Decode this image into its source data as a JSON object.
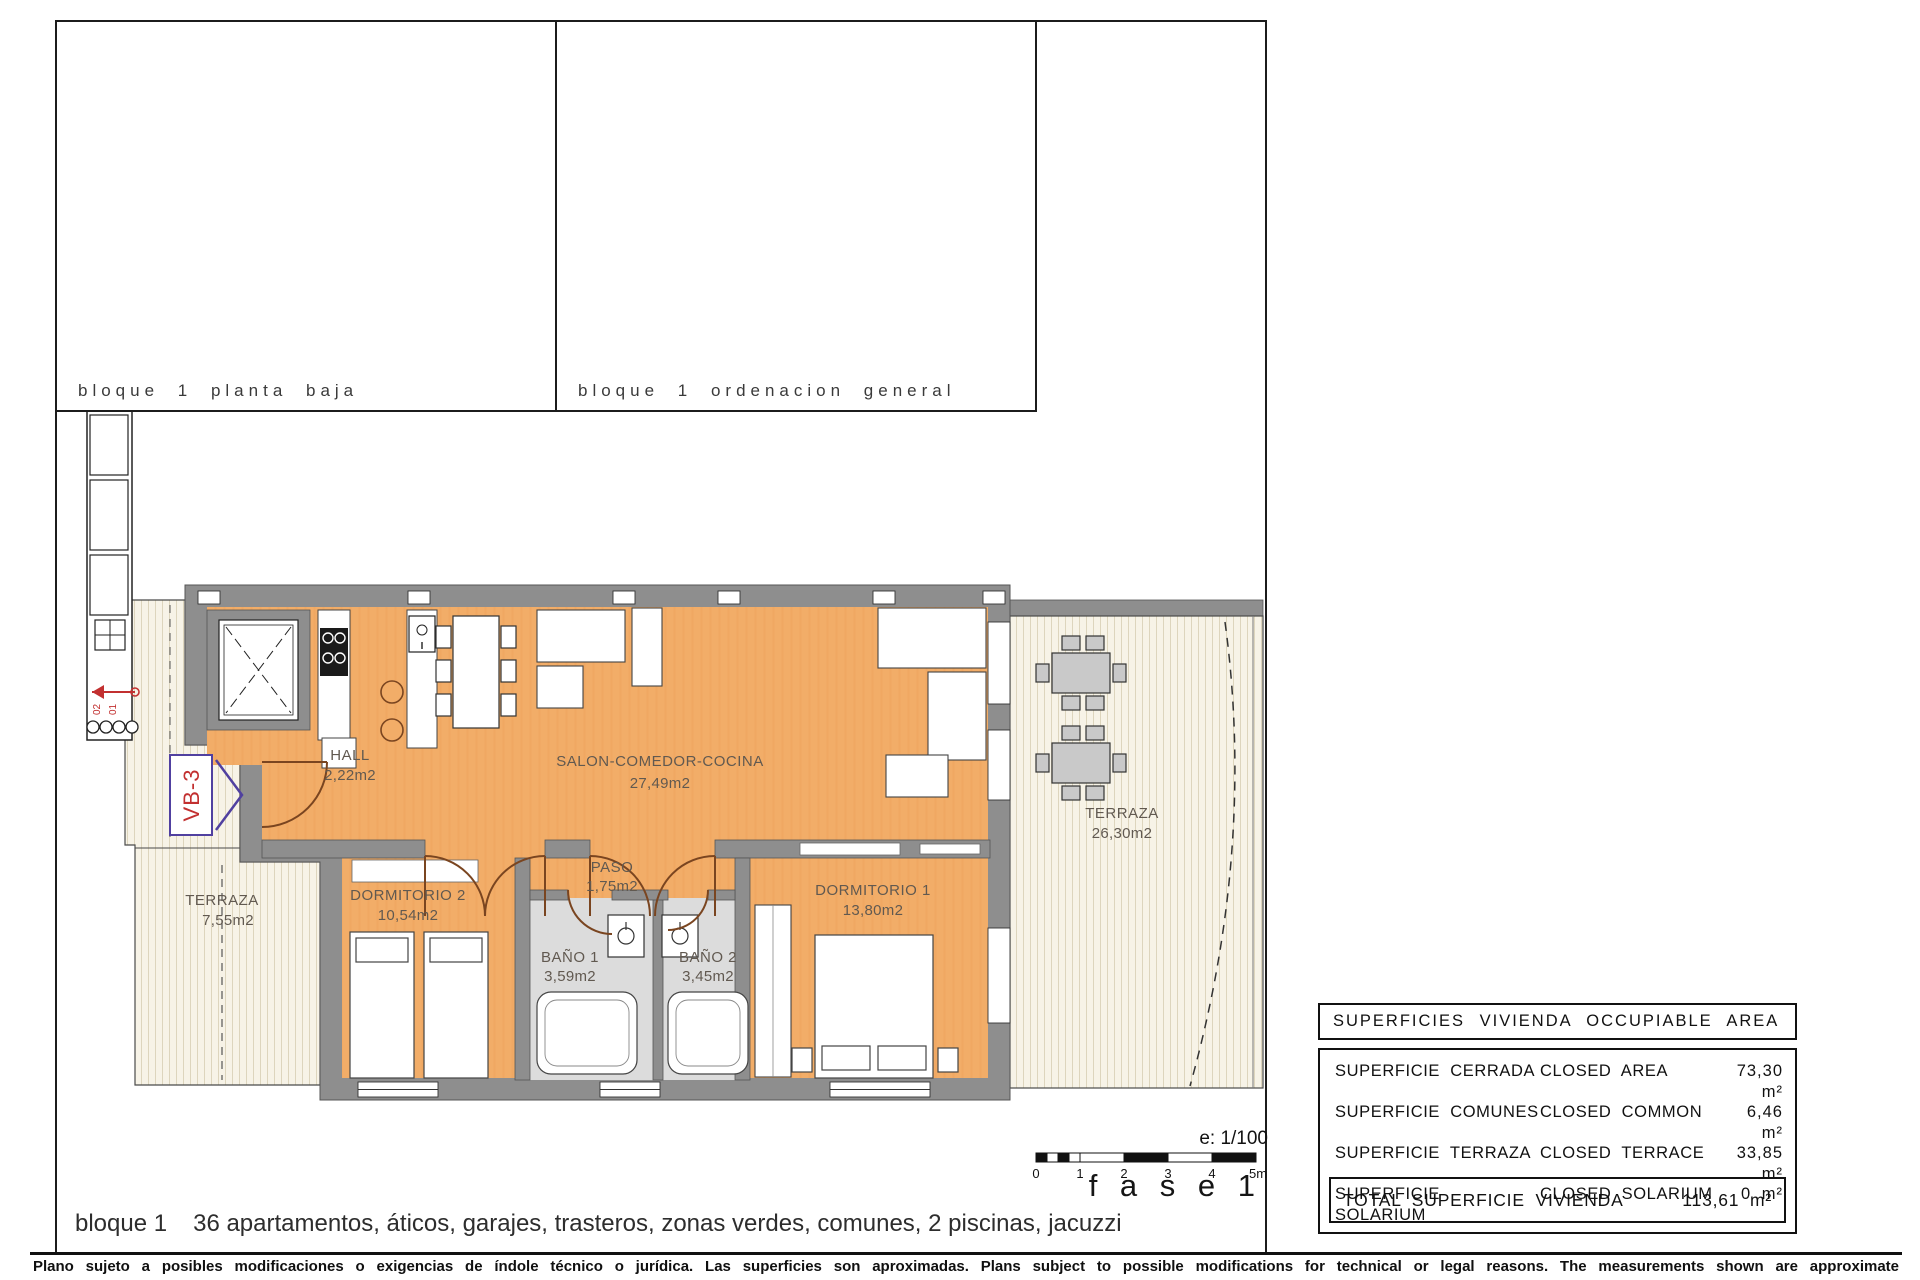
{
  "panels": {
    "planta_baja": {
      "caption": "bloque 1 planta baja",
      "unit_label": "VB-3"
    },
    "ordenacion": {
      "caption": "bloque 1 ordenacion general"
    }
  },
  "floor_plan": {
    "unit_tag": "VB-3",
    "rooms": [
      {
        "name": "HALL",
        "area": "2,22m2"
      },
      {
        "name": "SALON-COMEDOR-COCINA",
        "area": "27,49m2"
      },
      {
        "name": "PASO",
        "area": "1,75m2"
      },
      {
        "name": "DORMITORIO 2",
        "area": "10,54m2"
      },
      {
        "name": "DORMITORIO 1",
        "area": "13,80m2"
      },
      {
        "name": "BAÑO 1",
        "area": "3,59m2"
      },
      {
        "name": "BAÑO 2",
        "area": "3,45m2"
      },
      {
        "name": "TERRAZA",
        "area": "26,30m2"
      },
      {
        "name": "TERRAZA",
        "area": "7,55m2"
      }
    ],
    "stairwell_levels": [
      "02",
      "01"
    ]
  },
  "scale": {
    "ratio": "e: 1/100",
    "ticks": [
      "0",
      "1",
      "2",
      "3",
      "4",
      "5m"
    ]
  },
  "phase_label": "f a s e 1",
  "summary_table": {
    "title": "SUPERFICIES VIVIENDA OCCUPIABLE AREA",
    "rows": [
      {
        "es": "SUPERFICIE CERRADA",
        "en": "CLOSED AREA",
        "value": "73,30 m²"
      },
      {
        "es": "SUPERFICIE COMUNES",
        "en": "CLOSED COMMON",
        "value": "6,46 m²"
      },
      {
        "es": "SUPERFICIE TERRAZA",
        "en": "CLOSED TERRACE",
        "value": "33,85 m²"
      },
      {
        "es": "SUPERFICIE SOLARIUM",
        "en": "CLOSED SOLARIUM",
        "value": "0 m²"
      }
    ],
    "total_label": "TOTAL SUPERFICIE VIVIENDA",
    "total_value": "113,61 m²"
  },
  "bottom_line": {
    "block": "bloque 1",
    "features": "36 apartamentos, áticos, garajes, trasteros, zonas verdes, comunes, 2 piscinas, jacuzzi"
  },
  "footer": "Plano sujeto a posibles modificaciones o exigencias de índole técnico o jurídica. Las superficies son aproximadas. Plans subject to possible modifications for technical or legal reasons. The measurements shown are approximate",
  "colors": {
    "floor_orange": "#f2ad68",
    "wall_gray": "#8e8e8e",
    "bath_gray": "#dcdcdc",
    "terrace_cream": "#f7f3e7",
    "tag_red": "#c23030",
    "tag_purple": "#5040a0"
  }
}
